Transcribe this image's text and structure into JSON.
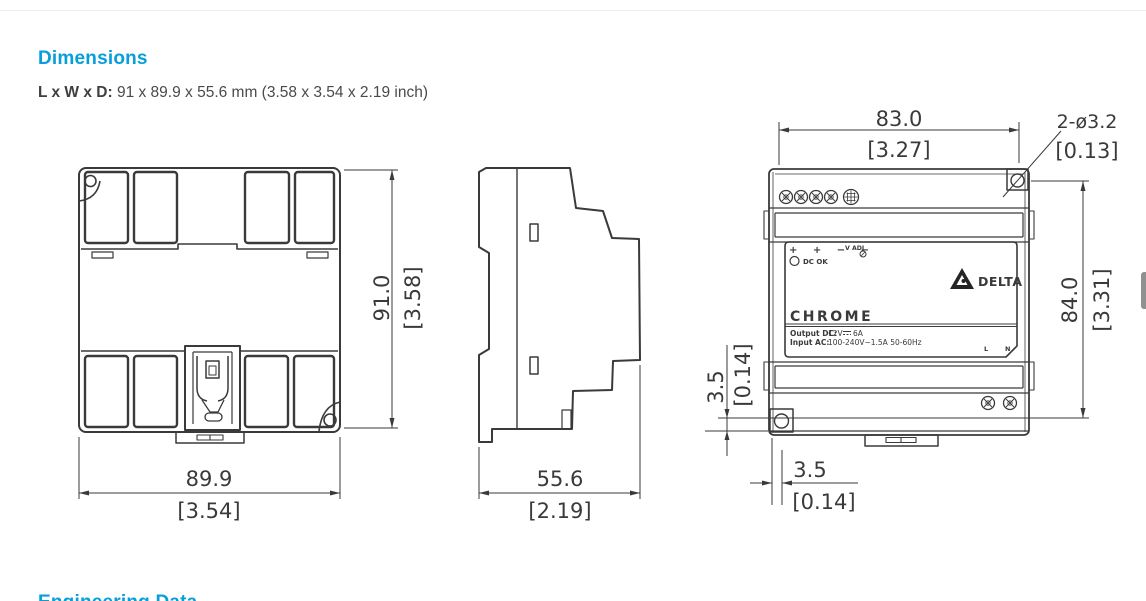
{
  "page": {
    "heading": "Dimensions",
    "lwd_label": "L x W x D:",
    "lwd_value": " 91 x 89.9 x 55.6 mm (3.58 x 3.54 x 2.19 inch)",
    "next_heading": "Engineering Data"
  },
  "colors": {
    "accent": "#069edb",
    "line": "#3a3a3a"
  },
  "dims": {
    "rear_width_mm": "89.9",
    "rear_width_in": "[3.54]",
    "rear_height_mm": "91.0",
    "rear_height_in": "[3.58]",
    "side_depth_mm": "55.6",
    "side_depth_in": "[2.19]",
    "front_width_mm": "83.0",
    "front_width_in": "[3.27]",
    "front_height_mm": "84.0",
    "front_height_in": "[3.31]",
    "hole_label": "2-ø3.2",
    "hole_in": "[0.13]",
    "offset_left_mm": "3.5",
    "offset_left_in": "[0.14]",
    "offset_bottom_mm": "3.5",
    "offset_bottom_in": "[0.14]"
  },
  "panel": {
    "terminals": "+  +  −  −",
    "vadj": "V ADJ",
    "dc_ok": "DC OK",
    "brand": "DELTA",
    "logo": "CHROME",
    "output_label": "Output DC:",
    "output_value_1": "12V",
    "output_value_2": "6A",
    "input_label": "Input AC:",
    "input_value": "100-240V~1.5A 50-60Hz",
    "line_label": "L",
    "neutral_label": "N"
  }
}
